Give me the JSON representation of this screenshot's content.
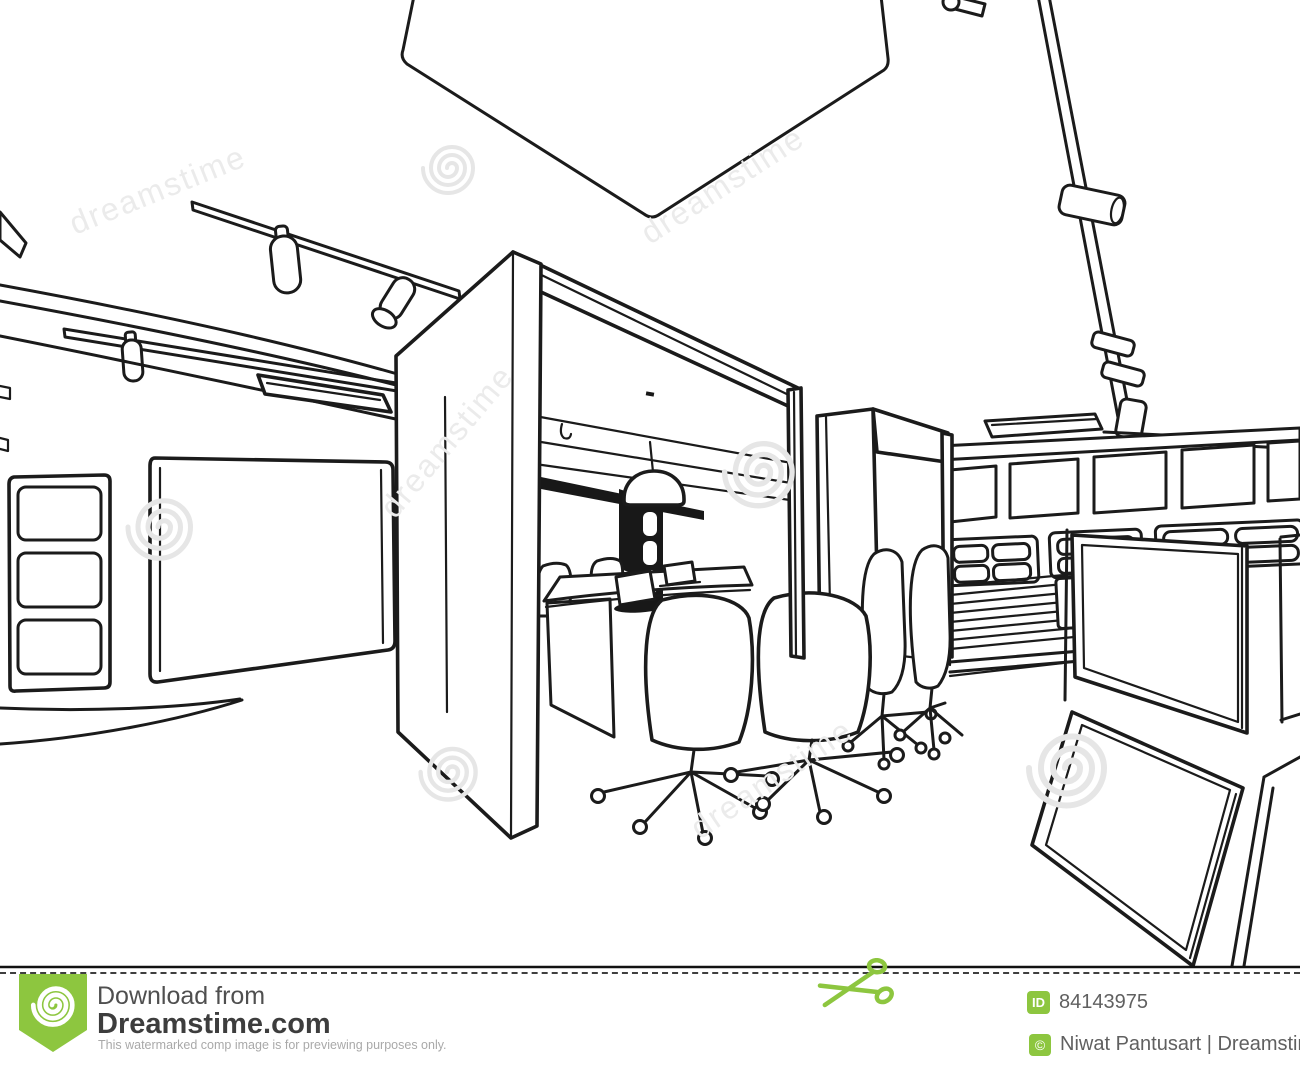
{
  "image": {
    "kind": "stock-photo watermarked preview",
    "style": "black and white interior outline sketch / line drawing of an office with meeting booths"
  },
  "scene": {
    "elements": [
      "ceiling-diamond-panel",
      "track-lights",
      "recessed-ceiling-light",
      "left-wall-whiteboard",
      "left-wall-cabinet",
      "meeting-booth-with-table",
      "pendant-lamp",
      "laptops",
      "office-chairs",
      "second-meeting-booth",
      "clerestory-windows",
      "locker-wall",
      "louver-panel",
      "tilted-display-frames"
    ]
  },
  "watermark": {
    "text": "dreamstime"
  },
  "colors": {
    "accent_green": "#8dc63f",
    "sketch_line": "#1b1b1b"
  },
  "footer": {
    "download_line1": "Download from",
    "download_line2": "Dreamstime.com",
    "disclaimer": "This watermarked comp image is for previewing purposes only.",
    "id_label": "ID",
    "id_value": "84143975",
    "copyright_symbol": "©",
    "credit": "Niwat Pantusart | Dreamstime.com"
  }
}
